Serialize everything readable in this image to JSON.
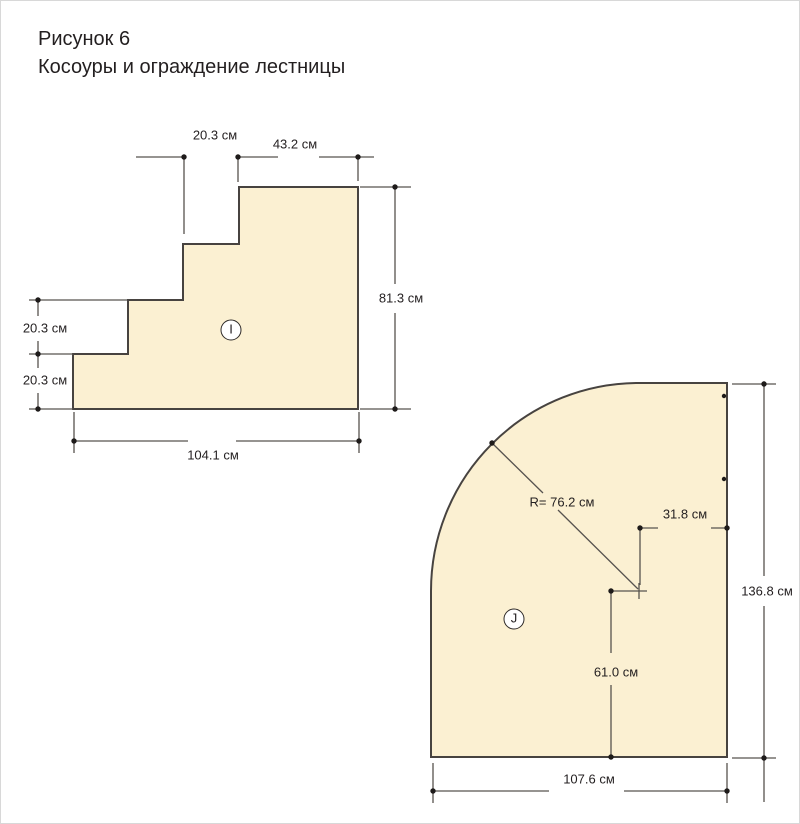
{
  "figure": {
    "number": "Рисунок 6",
    "caption": "Косоуры и ограждение лестницы"
  },
  "colors": {
    "part_fill": "#FBF0D2",
    "part_outline": "#474340",
    "dimension_line": "#57534F",
    "dot": "#1E1B1A",
    "text": "#231F20"
  },
  "stringer_part": {
    "label": "I",
    "dimensions": {
      "top_step_run": "20.3 см",
      "top_width": "43.2 см",
      "right_height": "81.3 см",
      "left_rise_upper": "20.3 см",
      "left_rise_lower": "20.3 см",
      "bottom_width": "104.1 см"
    }
  },
  "rounded_part": {
    "label": "J",
    "dimensions": {
      "radius": "R= 76.2 см",
      "center_to_edge": "31.8 см",
      "right_height": "136.8 см",
      "center_to_bottom": "61.0 см",
      "bottom_width": "107.6 см"
    }
  }
}
